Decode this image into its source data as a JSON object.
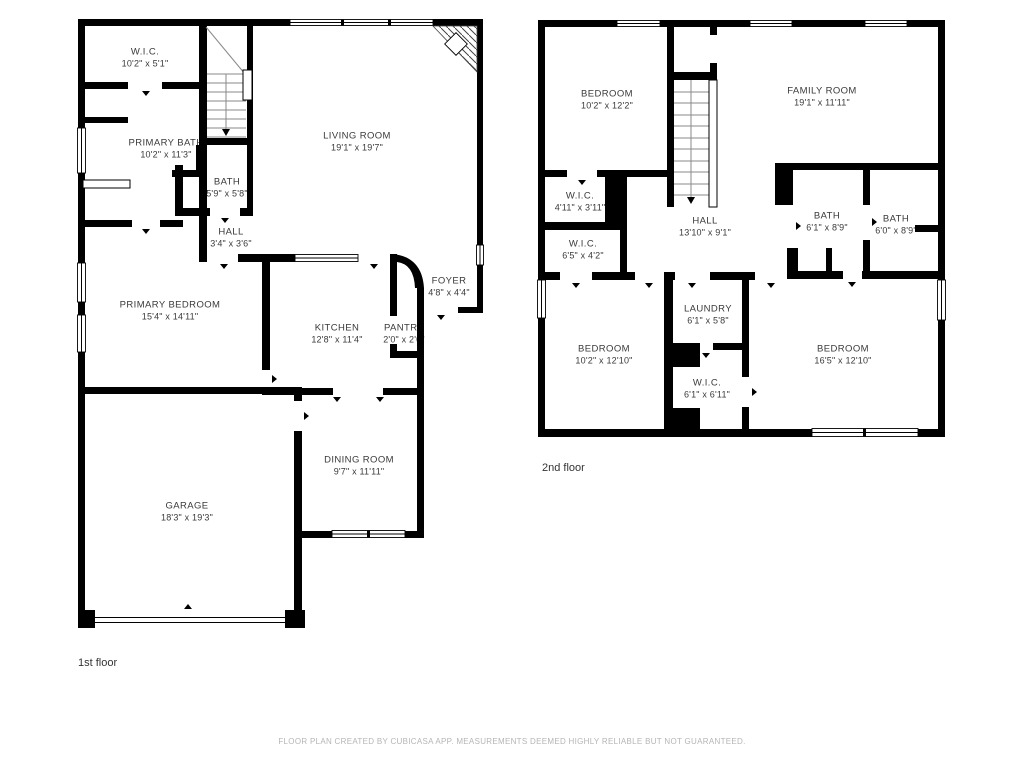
{
  "floors": [
    {
      "caption": "1st floor",
      "rooms": [
        {
          "name": "W.I.C.",
          "dims": "10'2\" x 5'1\""
        },
        {
          "name": "PRIMARY BATH",
          "dims": "10'2\" x 11'3\""
        },
        {
          "name": "BATH",
          "dims": "5'9\" x 5'8\""
        },
        {
          "name": "HALL",
          "dims": "3'4\" x 3'6\""
        },
        {
          "name": "LIVING ROOM",
          "dims": "19'1\" x 19'7\""
        },
        {
          "name": "PRIMARY BEDROOM",
          "dims": "15'4\" x 14'11\""
        },
        {
          "name": "KITCHEN",
          "dims": "12'8\" x 11'4\""
        },
        {
          "name": "PANTRY",
          "dims": "2'0\" x 2'0\""
        },
        {
          "name": "FOYER",
          "dims": "4'8\" x 4'4\""
        },
        {
          "name": "DINING ROOM",
          "dims": "9'7\" x 11'11\""
        },
        {
          "name": "GARAGE",
          "dims": "18'3\" x 19'3\""
        }
      ]
    },
    {
      "caption": "2nd floor",
      "rooms": [
        {
          "name": "BEDROOM",
          "dims": "10'2\" x 12'2\""
        },
        {
          "name": "FAMILY ROOM",
          "dims": "19'1\" x 11'11\""
        },
        {
          "name": "W.I.C.",
          "dims": "4'11\" x 3'11\""
        },
        {
          "name": "W.I.C.",
          "dims": "6'5\" x 4'2\""
        },
        {
          "name": "HALL",
          "dims": "13'10\" x 9'1\""
        },
        {
          "name": "BATH",
          "dims": "6'1\" x 8'9\""
        },
        {
          "name": "BATH",
          "dims": "6'0\" x 8'9\""
        },
        {
          "name": "LAUNDRY",
          "dims": "6'1\" x 5'8\""
        },
        {
          "name": "BEDROOM",
          "dims": "10'2\" x 12'10\""
        },
        {
          "name": "W.I.C.",
          "dims": "6'1\" x 6'11\""
        },
        {
          "name": "BEDROOM",
          "dims": "16'5\" x 12'10\""
        }
      ]
    }
  ],
  "footer": {
    "disclaimer": "FLOOR PLAN CREATED BY CUBICASA APP. MEASUREMENTS DEEMED HIGHLY RELIABLE BUT NOT GUARANTEED."
  },
  "colors": {
    "wall": "#000000",
    "label_text": "#3a3a3a",
    "footer_text": "#b5b5b5"
  }
}
